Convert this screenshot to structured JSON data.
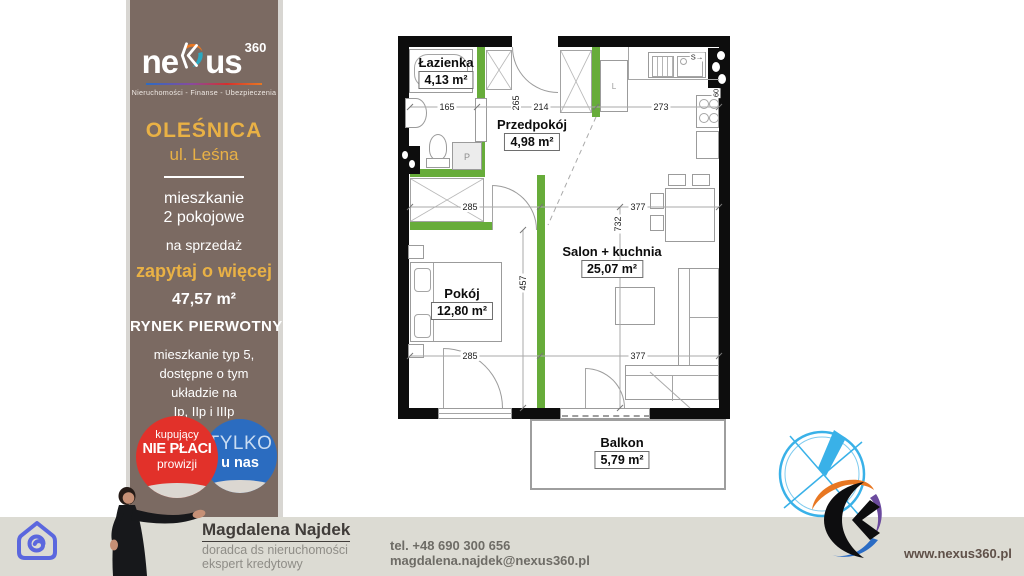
{
  "colors": {
    "sidebar": "#7b6a62",
    "gold": "#e9b145",
    "badge_red": "#e2312a",
    "badge_blue": "#2b6cc0",
    "wall_green": "#67ac3a",
    "footer_bar": "#dcdbd3",
    "logo_blue": "#39b1e8"
  },
  "sidebar": {
    "brand": {
      "prefix": "ne",
      "suffix": "us",
      "sup": "360",
      "tagline": "Nieruchomości - Finanse - Ubezpieczenia"
    },
    "city": "OLEŚNICA",
    "street": "ul. Leśna",
    "type_line1": "mieszkanie",
    "type_line2": "2 pokojowe",
    "sale": "na sprzedaż",
    "cta": "zapytaj o więcej",
    "area": "47,57 m²",
    "market": "RYNEK PIERWOTNY",
    "desc1": "mieszkanie typ 5,",
    "desc2": "dostępne o tym",
    "desc3": "układzie na",
    "desc4": "Ip, IIp i IIIp",
    "badge_red": {
      "l1": "kupujący",
      "l2": "NIE PŁACI",
      "l3": "prowizji"
    },
    "badge_blue": {
      "l1": "TYLKO",
      "l2": "u nas"
    }
  },
  "plan": {
    "rooms": {
      "bathroom": {
        "name": "Łazienka",
        "area": "4,13 m²"
      },
      "hallway": {
        "name": "Przedpokój",
        "area": "4,98 m²"
      },
      "room": {
        "name": "Pokój",
        "area": "12,80 m²"
      },
      "living": {
        "name": "Salon + kuchnia",
        "area": "25,07 m²"
      },
      "balcony": {
        "name": "Balkon",
        "area": "5,79 m²"
      }
    },
    "dims": {
      "bath_w": "165",
      "bath_h": "265",
      "hall_w": "214",
      "kitchen_w": "273",
      "room_w": "285",
      "living_w": "377",
      "living_h": "732",
      "room_h": "457",
      "room_w2": "285",
      "living_w2": "377",
      "shaft": "S→",
      "shaft_h": "60"
    },
    "marks": {
      "closet": "L",
      "washer": "P"
    }
  },
  "footer": {
    "agent": "Magdalena Najdek",
    "role1": "doradca ds nieruchomości",
    "role2": "ekspert kredytowy",
    "phone": "tel. +48 690 300 656",
    "email": "magdalena.najdek@nexus360.pl",
    "website": "www.nexus360.pl"
  }
}
